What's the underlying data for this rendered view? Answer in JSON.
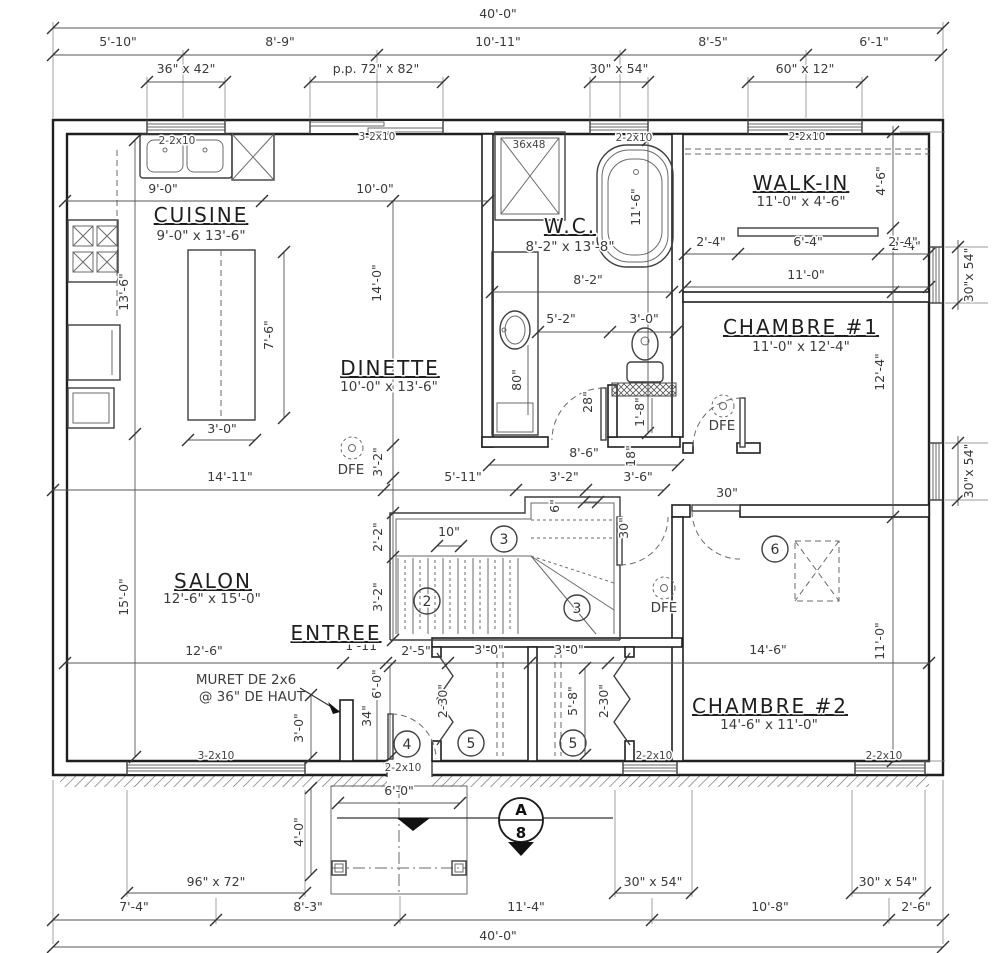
{
  "drawing": {
    "dims_top": {
      "overall": "40'-0\"",
      "segments": [
        "5'-10\"",
        "8'-9\"",
        "10'-11\"",
        "8'-5\"",
        "6'-1\""
      ],
      "window_labels": [
        "36\" x 42\"",
        "p.p. 72\" x 82\"",
        "30\" x 54\"",
        "60\" x 12\""
      ]
    },
    "dims_bottom": {
      "overall": "40'-0\"",
      "segments": [
        "7'-4\"",
        "8'-3\"",
        "11'-4\"",
        "10'-8\"",
        "2'-6\""
      ],
      "window_labels": [
        "96\" x 72\"",
        "30\" x 54\"",
        "30\" x 54\""
      ],
      "porch": [
        "6'-0\"",
        "4'-0\""
      ]
    },
    "dims_right": {
      "inner": [
        "4'-6\"",
        "2'-4\"",
        "12'-4\"",
        "11'-0\""
      ],
      "window_labels": [
        "30\"x 54\"",
        "30\"x 54\""
      ]
    },
    "rooms": {
      "cuisine": {
        "name": "CUISINE",
        "size": "9'-0\" x 13'-6\""
      },
      "wc": {
        "name": "W.C.",
        "size": "8'-2\" x 13'-8\""
      },
      "walkin": {
        "name": "WALK-IN",
        "size": "11'-0\" x 4'-6\""
      },
      "chambre1": {
        "name": "CHAMBRE #1",
        "size": "11'-0\" x 12'-4\""
      },
      "dinette": {
        "name": "DINETTE",
        "size": "10'-0\" x 13'-6\""
      },
      "salon": {
        "name": "SALON",
        "size": "12'-6\" x 15'-0\""
      },
      "entree": {
        "name": "ENTREE"
      },
      "chambre2": {
        "name": "CHAMBRE #2",
        "size": "14'-6\" x 11'-0\""
      }
    },
    "kitchen_dims": [
      "9'-0\"",
      "10'-0\"",
      "13'-6\"",
      "15'-0\"",
      "7'-6\"",
      "3'-0\"",
      "14'-0\""
    ],
    "wc_dims": [
      "36x48",
      "11'-6\"",
      "8'-2\"",
      "5'-2\"",
      "3'-0\"",
      "80\"",
      "28\"",
      "18\"",
      "1'-8\""
    ],
    "walkin_dims": [
      "2'-4\"",
      "6'-4\"",
      "2'-4\"",
      "11'-0\""
    ],
    "hall_dims": [
      "8'-6\"",
      "14'-11\"",
      "5'-11\"",
      "3'-2\"",
      "3'-6\"",
      "6\"",
      "10\"",
      "3'-2\"",
      "2'-2\"",
      "3'-2\"",
      "30\"",
      "30\""
    ],
    "entree_dims": [
      "12'-6\"",
      "1'-11\"",
      "2'-5\"",
      "3'-0\"",
      "3'-0\"",
      "14'-6\"",
      "6'-0\"",
      "34\"",
      "3'-0\""
    ],
    "closet_dims": [
      "2-30\"",
      "5'-8\"",
      "2-30\""
    ],
    "lintels_top": [
      "2-2x10",
      "3-2x10",
      "2-2x10",
      "2-2x10"
    ],
    "lintels_bottom": [
      "3-2x10",
      "2-2x10",
      "2-2x10",
      "2-2x10"
    ],
    "note_muret": [
      "MURET DE 2x6",
      "@ 36\" DE HAUT"
    ],
    "markers": [
      "2",
      "3",
      "3",
      "4",
      "5",
      "5",
      "6"
    ],
    "dfe_label": "DFE",
    "section_marker": {
      "top": "A",
      "bottom": "8"
    }
  }
}
